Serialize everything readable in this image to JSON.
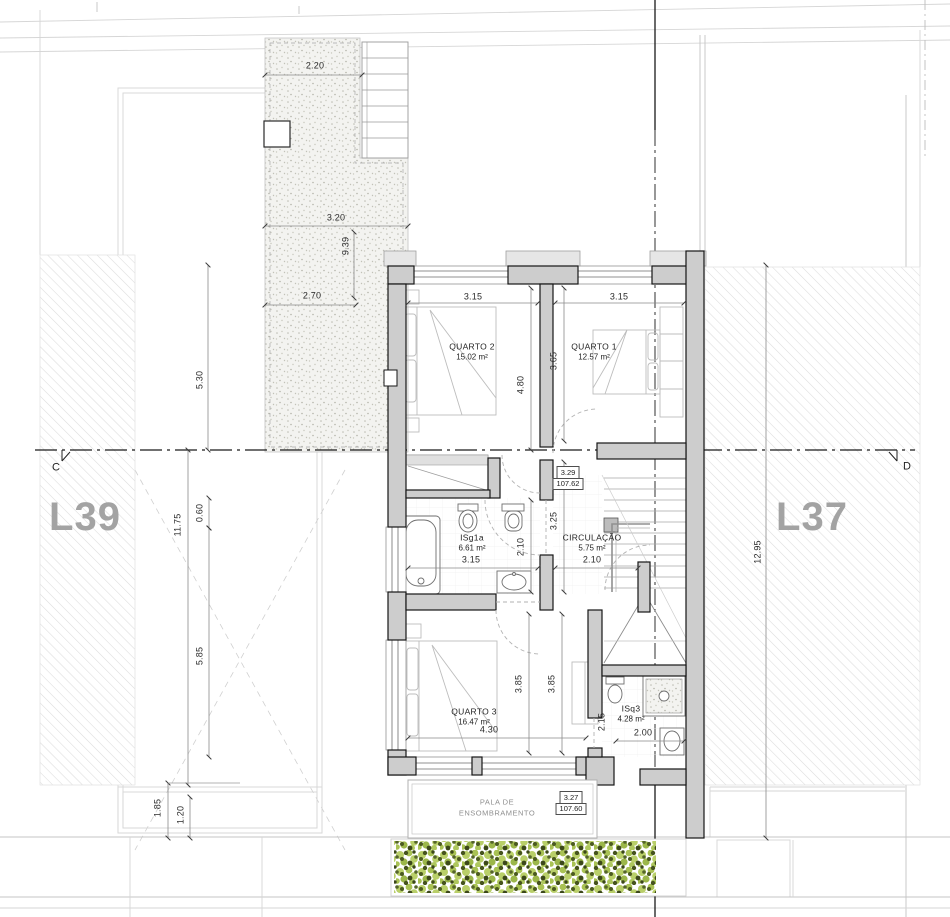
{
  "lots": {
    "left": "L39",
    "right": "L37"
  },
  "section": {
    "left_marker": "C",
    "right_marker": "D"
  },
  "rooms": {
    "quarto2": {
      "name": "QUARTO 2",
      "area": "15.02 m²"
    },
    "quarto1": {
      "name": "QUARTO 1",
      "area": "12.57 m²"
    },
    "quarto3": {
      "name": "QUARTO 3",
      "area": "16.47 m²"
    },
    "circulacao": {
      "name": "CIRCULAÇÃO",
      "area": "5.75 m²"
    },
    "isg1a": {
      "name": "ISg1a",
      "area": "6.61 m²"
    },
    "isq3": {
      "name": "ISq3",
      "area": "4.28 m²"
    }
  },
  "levels": {
    "upper": {
      "value": "3.29",
      "elevation": "107.62"
    },
    "lower": {
      "value": "3.27",
      "elevation": "107.60"
    }
  },
  "shading": {
    "line1": "PALA DE",
    "line2": "ENSOMBRAMENTO"
  },
  "dims": {
    "terrace_width": "2.20",
    "terrace_mid": "3.20",
    "terrace_total": "9.39",
    "terrace_lower": "2.70",
    "site_left_upper": "5.30",
    "site_left_total": "11.75",
    "site_left_offset": "0.60",
    "site_left_lower": "5.85",
    "pala_left": "1.85",
    "pala_inner": "1.20",
    "site_right_total": "12.95",
    "q2_width": "3.15",
    "q1_width": "3.15",
    "q2_depth": "4.80",
    "q1_depth": "3.65",
    "circ_depth": "3.25",
    "bath_depth": "2.10",
    "bath_width": "3.15",
    "circ_width": "2.10",
    "q3_depth_left": "3.85",
    "q3_depth_right": "3.85",
    "q3_width": "4.30",
    "isq3_depth": "2.15",
    "isq3_width": "2.00"
  }
}
